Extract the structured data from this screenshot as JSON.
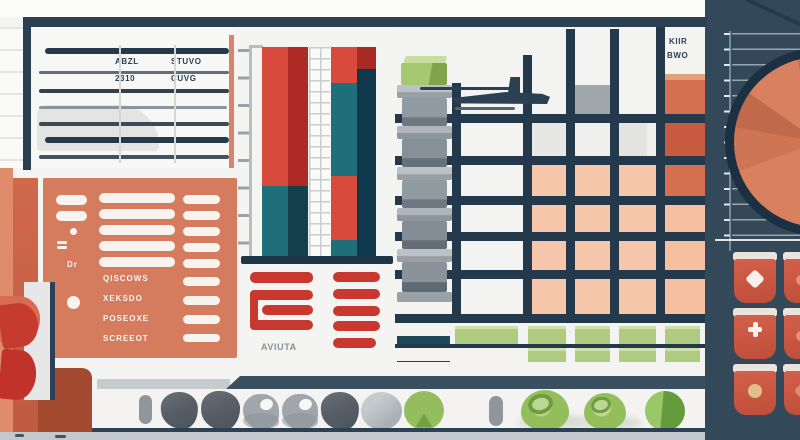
{
  "scene": {
    "title": "Flat-style illustration of an analytics dashboard with charts, tables and toolbars"
  },
  "decor_text": {
    "table_row1_left": "ABZL",
    "table_row1_right": "STUVO",
    "table_row2_left": "2310",
    "table_row2_right": "CUVG",
    "grid_corner_line1": "KIIR",
    "grid_corner_line2": "BWO",
    "bar_caption": "AVIUTA",
    "form_label_dr": "Dr",
    "form_rows": [
      "QISCOWS",
      "XEKSDO",
      "POSEOXE",
      "SCREEOT"
    ]
  },
  "colors": {
    "navy": "#2B4153",
    "gridline_navy": "#24394C",
    "panel_salmon": "#D57C5E",
    "red": "#C8382E",
    "bar_red": "#D84A3B",
    "bar_dark_red": "#AE2B25",
    "teal": "#1F6F7A",
    "dark_teal": "#153F4D",
    "pink_cell": "#F7C7AB",
    "salmon_cell": "#D4704F",
    "green": "#94BE5D",
    "green_bar": "#AECB7F",
    "gray_block": "#8F979D",
    "pie_salmon": "#D8805F",
    "cup_red": "#D2604A",
    "floor": "#C2C9CE"
  },
  "chart_data": [
    {
      "type": "bar",
      "subtype": "stacked-vertical",
      "title": "",
      "xlabel": "",
      "ylabel": "",
      "ylim": [
        0,
        100
      ],
      "unit": "percent-of-axis-height",
      "categories": [
        "stack-1",
        "stack-2"
      ],
      "series": [
        {
          "name": "red-top",
          "color": "#D84A3B",
          "values": [
            66,
            17
          ]
        },
        {
          "name": "teal-mid",
          "color": "#1F6F7A",
          "values": [
            34,
            45
          ]
        },
        {
          "name": "red-lower",
          "color": "#D84A3B",
          "values": [
            0,
            31
          ]
        },
        {
          "name": "teal-base",
          "color": "#1F6F7A",
          "values": [
            0,
            7
          ]
        }
      ],
      "legend": false,
      "grid": false
    },
    {
      "type": "pie",
      "title": "",
      "slices": [
        {
          "label": "wedge-1",
          "value": 40,
          "color": "#D8805F"
        },
        {
          "label": "wedge-2",
          "value": 30,
          "color": "#CE7555"
        },
        {
          "label": "wedge-3",
          "value": 25,
          "color": "#C16A4B"
        },
        {
          "label": "wedge-4",
          "value": 40,
          "color": "#D8805F"
        },
        {
          "label": "wedge-5",
          "value": 30,
          "color": "#C87050"
        },
        {
          "label": "wedge-6",
          "value": 40,
          "color": "#D8805F"
        },
        {
          "label": "wedge-7",
          "value": 30,
          "color": "#CB7253"
        },
        {
          "label": "wedge-8",
          "value": 40,
          "color": "#D8805F"
        },
        {
          "label": "wedge-9",
          "value": 25,
          "color": "#C16A4B"
        },
        {
          "label": "wedge-10",
          "value": 60,
          "color": "#D8805F"
        }
      ],
      "legend": false
    },
    {
      "type": "heatmap",
      "rows": 6,
      "cols": 6,
      "matrix": [
        [
          "white",
          "white",
          "gray",
          "white",
          "white",
          "salmon"
        ],
        [
          "white",
          "lightgray",
          "lightgray",
          "lightgray",
          "white",
          "red-salmon"
        ],
        [
          "white",
          "white",
          "pink",
          "pink",
          "pink",
          "salmon"
        ],
        [
          "white",
          "white",
          "pink",
          "pink",
          "pink",
          "pink"
        ],
        [
          "white",
          "white",
          "pink",
          "pink",
          "pink",
          "pink"
        ],
        [
          "white",
          "white",
          "pink",
          "pink",
          "pink",
          "pink"
        ]
      ]
    }
  ]
}
